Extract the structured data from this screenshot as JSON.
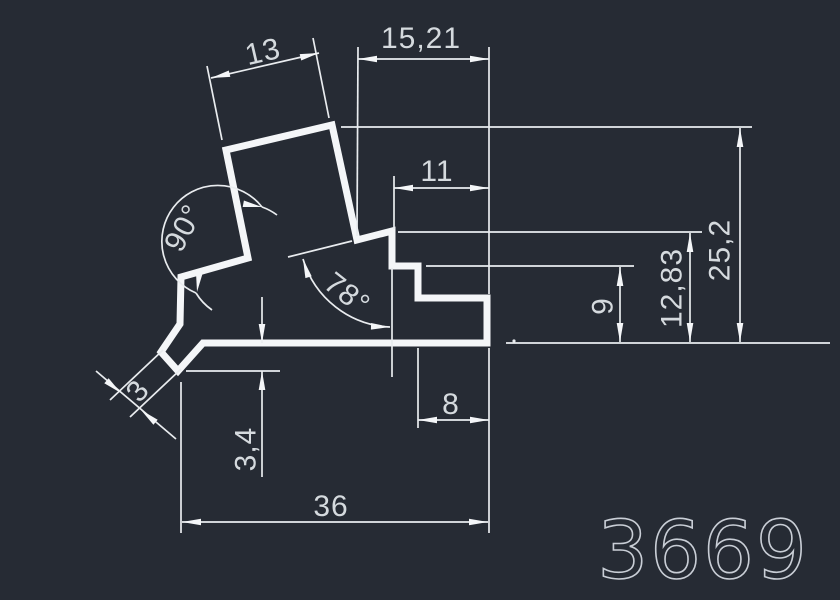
{
  "drawing": {
    "colors": {
      "background": "#262b34",
      "line": "#f4f6f8",
      "text": "#d5dade"
    },
    "part_number": "3669",
    "linear_dimensions": {
      "top_flange_width": "13",
      "top_offset": "15,21",
      "upper_step_width": "11",
      "overall_height": "25,2",
      "mid_height": "12,83",
      "step_height": "9",
      "lower_step_width": "8",
      "base_width": "36",
      "base_thickness": "3,4",
      "lip_thickness": "3"
    },
    "angle_dimensions": {
      "left_angle": "90°",
      "right_angle": "78°"
    }
  }
}
